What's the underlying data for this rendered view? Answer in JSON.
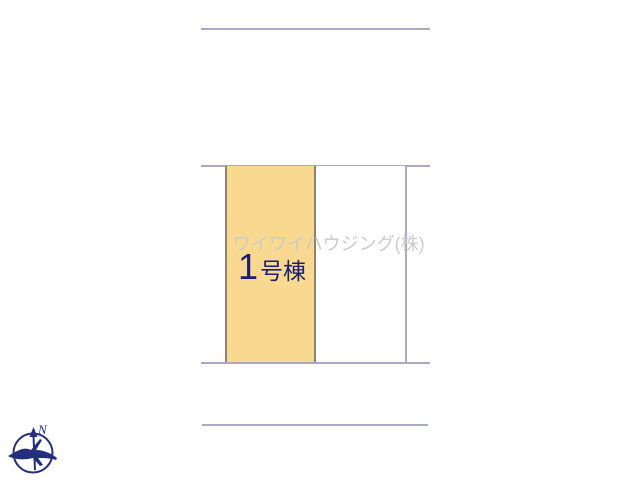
{
  "colors": {
    "line": "#a9a9c4",
    "parcel-fill": "#f9d990",
    "parcel-border": "#8b8375",
    "label": "#1b1e75",
    "watermark": "#cbcbcb",
    "compass": "#232e7d"
  },
  "plan": {
    "watermark": "ワイワイハウジング(株)",
    "building": {
      "number": "1",
      "suffix": "号棟"
    }
  },
  "compass": {
    "north_label": "N"
  }
}
